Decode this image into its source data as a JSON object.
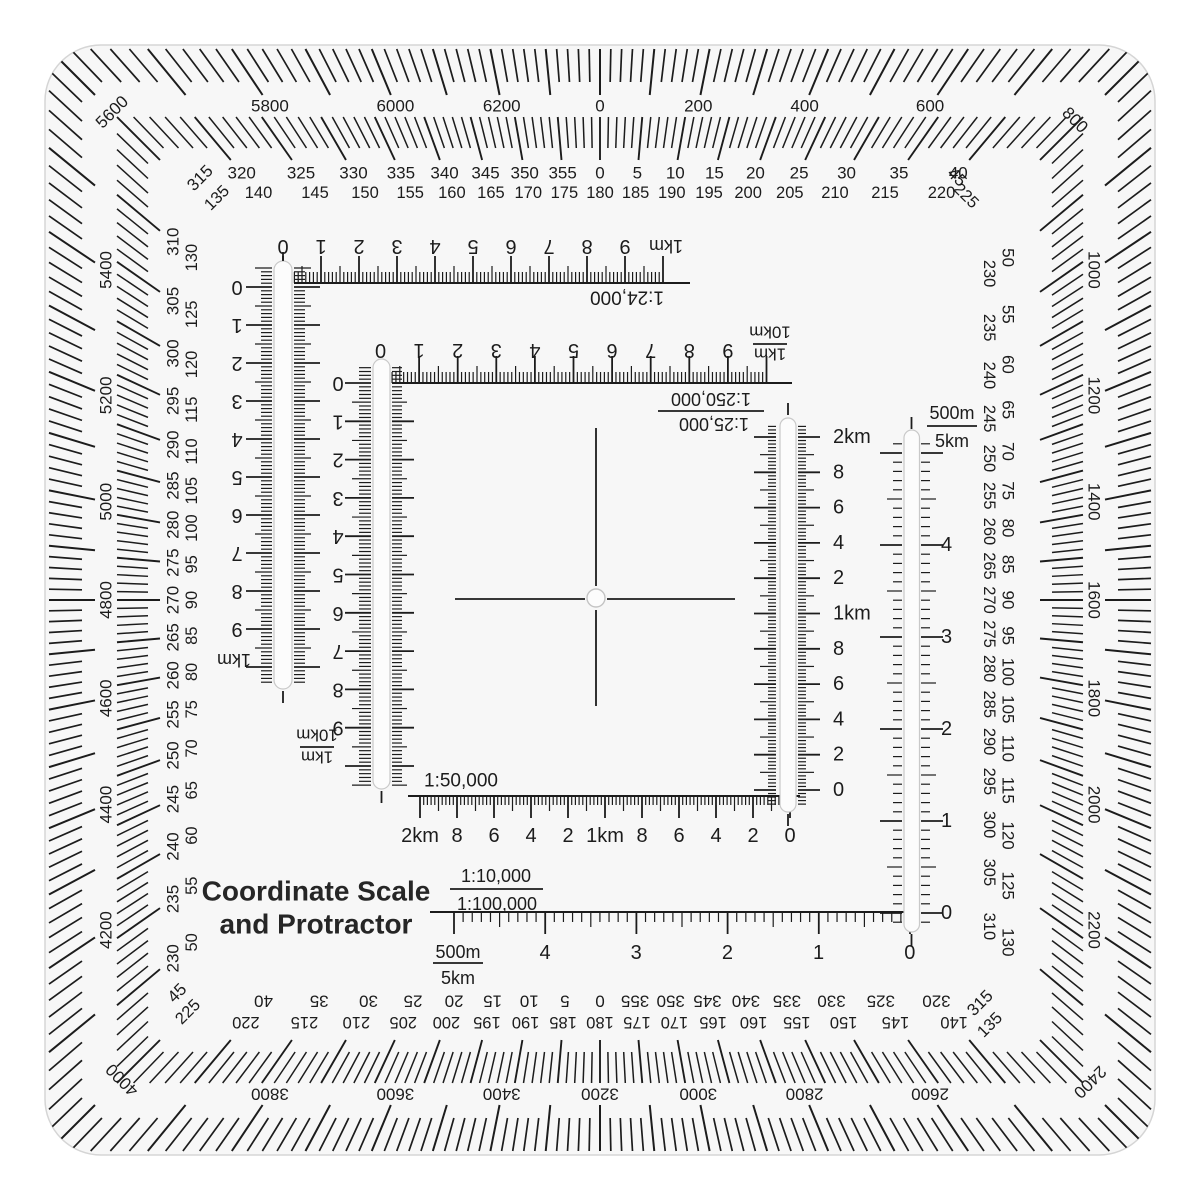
{
  "title": {
    "line1": "Coordinate Scale",
    "line2": "and Protractor"
  },
  "colors": {
    "ink": "#1c1c1c",
    "red_ink": "#7b3030",
    "plate": "#f7f7f7",
    "plate_edge": "#d5d5d5",
    "slot_fill": "#fcfcfc",
    "slot_stroke": "#c9c9c9"
  },
  "mils_ring": {
    "units": "mils",
    "step_minor": 20,
    "step_major": 100,
    "step_label": 200,
    "labels": [
      "0",
      "200",
      "400",
      "600",
      "800",
      "1000",
      "1200",
      "1400",
      "1600",
      "1800",
      "2000",
      "2200",
      "2400",
      "2600",
      "2800",
      "3000",
      "3200",
      "3400",
      "3600",
      "3800",
      "4000",
      "4200",
      "4400",
      "4600",
      "4800",
      "5000",
      "5200",
      "5400",
      "5600",
      "5800",
      "6000",
      "6200"
    ]
  },
  "degree_ring": {
    "units": "degrees",
    "step_minor": 1,
    "step_label": 5,
    "top": {
      "black": [
        "320",
        "325",
        "330",
        "335",
        "340",
        "345",
        "350",
        "355",
        "0",
        "5",
        "10",
        "15",
        "20",
        "25",
        "30",
        "35",
        "40"
      ],
      "red": [
        "140",
        "145",
        "150",
        "155",
        "160",
        "165",
        "170",
        "175",
        "180",
        "185",
        "190",
        "195",
        "200",
        "205",
        "210",
        "215",
        "220"
      ]
    },
    "right": {
      "black": [
        "50",
        "55",
        "60",
        "65",
        "70",
        "75",
        "80",
        "85",
        "90",
        "95",
        "100",
        "105",
        "110",
        "115",
        "120",
        "125",
        "130"
      ],
      "red": [
        "230",
        "235",
        "240",
        "245",
        "250",
        "255",
        "260",
        "265",
        "270",
        "275",
        "280",
        "285",
        "290",
        "295",
        "300",
        "305",
        "310"
      ]
    },
    "bottom": {
      "black": [
        "40",
        "35",
        "30",
        "25",
        "20",
        "15",
        "10",
        "5",
        "0",
        "355",
        "350",
        "345",
        "340",
        "335",
        "330",
        "325",
        "320"
      ],
      "red": [
        "220",
        "215",
        "210",
        "205",
        "200",
        "195",
        "190",
        "185",
        "180",
        "175",
        "170",
        "165",
        "160",
        "155",
        "150",
        "145",
        "140"
      ]
    },
    "left": {
      "black": [
        "310",
        "305",
        "300",
        "295",
        "290",
        "285",
        "280",
        "275",
        "270",
        "265",
        "260",
        "255",
        "250",
        "245",
        "240",
        "235",
        "230"
      ],
      "red": [
        "130",
        "125",
        "120",
        "115",
        "110",
        "105",
        "100",
        "95",
        "90",
        "85",
        "80",
        "75",
        "70",
        "65",
        "60",
        "55",
        "50"
      ]
    },
    "corners": {
      "top_left": {
        "black": "315",
        "red": "135"
      },
      "top_right": {
        "black": "45",
        "red": "225"
      },
      "bottom_right": {
        "black": "315",
        "red": "135"
      },
      "bottom_left": {
        "black": "45",
        "red": "225"
      }
    }
  },
  "scales": {
    "s24000": {
      "label": "1:24,000",
      "numbers": [
        "0",
        "1",
        "2",
        "3",
        "4",
        "5",
        "6",
        "7",
        "8",
        "9"
      ],
      "end_label": "1km"
    },
    "s25000": {
      "label_top": "1:250,000",
      "label_bottom": "1:25,000",
      "fraction": {
        "num": "1km",
        "den": "10km"
      },
      "numbers": [
        "0",
        "1",
        "2",
        "3",
        "4",
        "5",
        "6",
        "7",
        "8",
        "9"
      ]
    },
    "s50000": {
      "label": "1:50,000",
      "numbers": [
        "2km",
        "8",
        "6",
        "4",
        "2",
        "1km",
        "8",
        "6",
        "4",
        "2",
        "0"
      ]
    },
    "s10000_100000": {
      "fraction_scales": {
        "num": "1:10,000",
        "den": "1:100,000"
      },
      "fraction_units": {
        "num": "500m",
        "den": "5km"
      },
      "numbers": [
        "4",
        "3",
        "2",
        "1",
        "0"
      ]
    }
  }
}
